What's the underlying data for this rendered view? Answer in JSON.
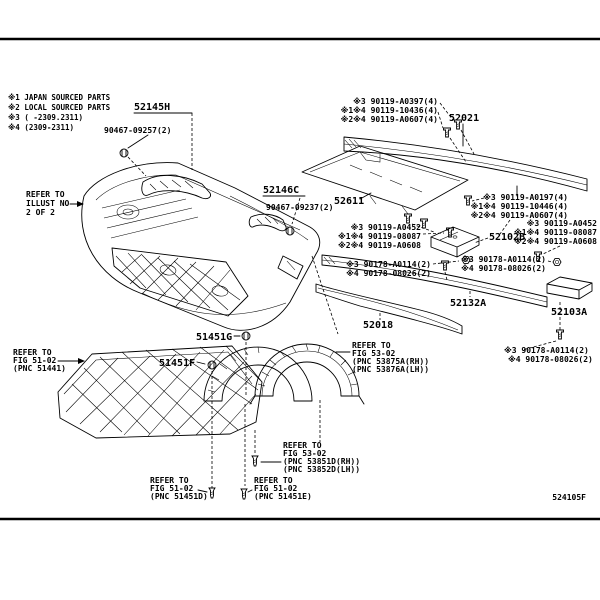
{
  "page": {
    "background": "#ffffff",
    "line_color": "#000000",
    "figure_code": "524105F"
  },
  "legend": {
    "lines": [
      "※1 JAPAN SOURCED PARTS",
      "※2 LOCAL SOURCED PARTS",
      "※3 (    -2309.2311)",
      "※4 (2309-2311)"
    ]
  },
  "parts": {
    "bracket_52145h": "52145H",
    "clip_52145h": "90467-09257(2)",
    "bracket_52146c": "52146C",
    "clip_52146c": "90467-09237(2)",
    "plate_52611": "52611",
    "reinforcement_52021": "52021",
    "extension_52102b": "52102B",
    "bar_52132a": "52132A",
    "seal_52018": "52018",
    "bracket_52103a": "52103A",
    "clip_51451g": "51451G",
    "clip_51451f": "51451F"
  },
  "fasteners": {
    "set_top_right": [
      "※3 90119-A0397(4)",
      "※1※4 90119-10436(4)",
      "※2※4 90119-A0607(4)"
    ],
    "set_mid_right": [
      "※3 90119-A0197(4)",
      "※1※4 90119-10446(4)",
      "※2※4 90119-A0607(4)"
    ],
    "set_mid_left": [
      "※3 90119-A0452",
      "※1※4 90119-08087",
      "※2※4 90119-A0608"
    ],
    "set_far_right": [
      "※3 90119-A0452",
      "※1※4 90119-08087",
      "※2※4 90119-A0608"
    ],
    "pair_left": [
      "※3 90178-A0114(2)",
      "※4 90178-08026(2)"
    ],
    "pair_right": [
      "※3 90178-A0114(2)",
      "※4 90178-08026(2)"
    ],
    "pair_bottom": [
      "※3 90178-A0114(2)",
      "※4 90178-08026(2)"
    ]
  },
  "references": {
    "illust": [
      "REFER TO",
      "ILLUST NO",
      "2 OF 2"
    ],
    "under_cover": [
      "REFER TO",
      "FIG 51-02",
      "(PNC 51441)"
    ],
    "fender_liner": [
      "REFER TO",
      "FIG 53-02",
      "(PNC 53875A(RH))",
      "(PNC 53876A(LH))"
    ],
    "liner_seal": [
      "REFER TO",
      "FIG 53-02",
      "(PNC 53851D(RH))",
      "(PNC 53852D(LH))"
    ],
    "cover_d": [
      "REFER TO",
      "FIG 51-02",
      "(PNC 51451D)"
    ],
    "cover_e": [
      "REFER TO",
      "FIG 51-02",
      "(PNC 51451E)"
    ]
  }
}
